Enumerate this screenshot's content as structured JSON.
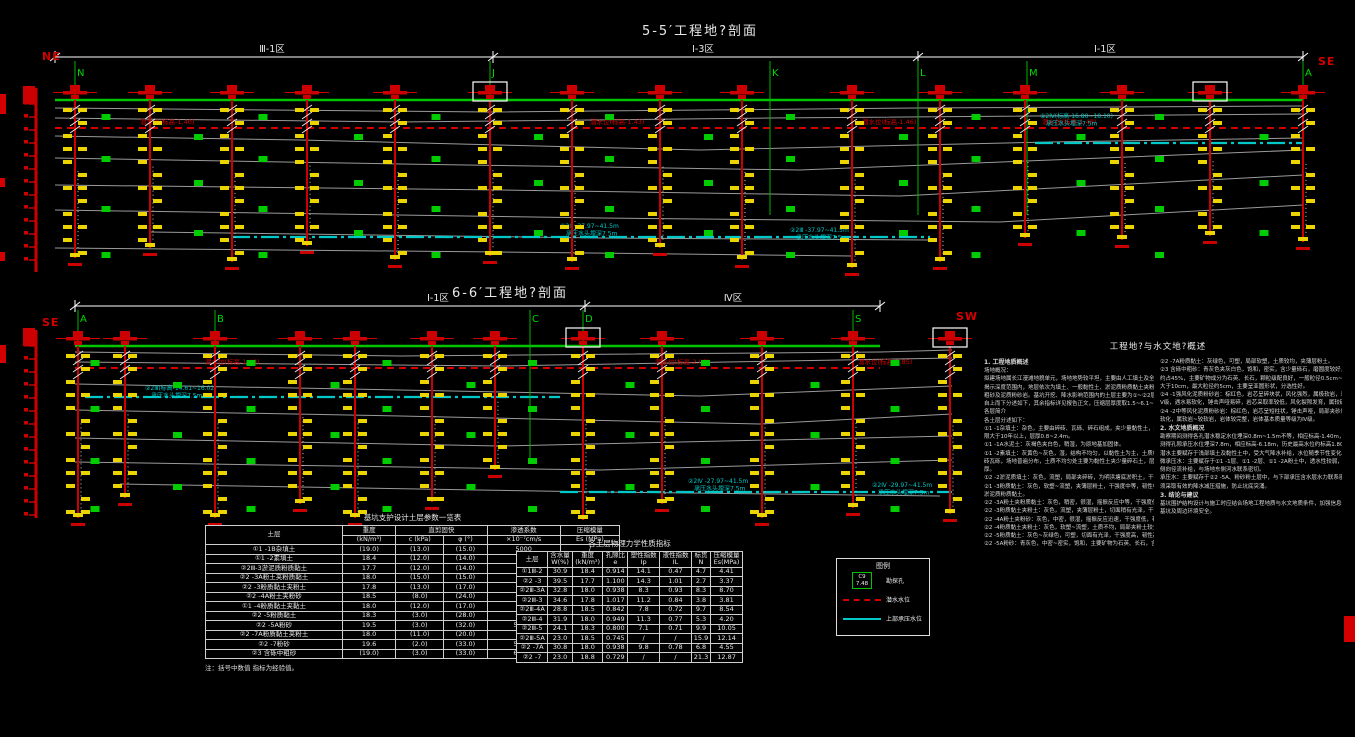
{
  "notes_title": "工程地?与水文地?概述",
  "sections": [
    {
      "id": "5-5",
      "title": "5-5′工程地?剖面",
      "compass_left": "NE",
      "compass_right": "SE",
      "dim_y": 57,
      "x0": 55,
      "x1": 1303,
      "ground_y": 100,
      "letter_y": 76,
      "zones": [
        {
          "from": 55,
          "to": 493,
          "label": "Ⅲ-1区",
          "label_x": 272
        },
        {
          "from": 493,
          "to": 918,
          "label": "Ⅰ-3区",
          "label_x": 703
        },
        {
          "from": 918,
          "to": 1303,
          "label": "Ⅰ-1区",
          "label_x": 1105
        }
      ],
      "markers": [
        {
          "letter": "N",
          "x": 75
        },
        {
          "letter": "J",
          "x": 490
        },
        {
          "letter": "K",
          "x": 770
        },
        {
          "letter": "L",
          "x": 918
        },
        {
          "letter": "M",
          "x": 1027
        },
        {
          "letter": "A",
          "x": 1303
        }
      ],
      "boreholes": [
        {
          "x": 75,
          "b": 258
        },
        {
          "x": 150,
          "b": 248
        },
        {
          "x": 232,
          "b": 262
        },
        {
          "x": 307,
          "b": 246
        },
        {
          "x": 395,
          "b": 260
        },
        {
          "x": 490,
          "b": 256,
          "boxed": true
        },
        {
          "x": 572,
          "b": 262
        },
        {
          "x": 660,
          "b": 248
        },
        {
          "x": 742,
          "b": 260
        },
        {
          "x": 852,
          "b": 268
        },
        {
          "x": 940,
          "b": 262
        },
        {
          "x": 1025,
          "b": 238
        },
        {
          "x": 1122,
          "b": 240
        },
        {
          "x": 1210,
          "b": 236,
          "boxed": true
        },
        {
          "x": 1303,
          "b": 242
        }
      ],
      "waterline": {
        "y": 128,
        "labels": [
          {
            "x": 140,
            "t": "潜水位(标高-1.40)"
          },
          {
            "x": 590,
            "t": "潜水位(标高-1.43)"
          },
          {
            "x": 862,
            "t": "潜水位(标高-1.46)"
          },
          {
            "x": 1042,
            "t": "潜水位(标高-1.48)"
          }
        ]
      },
      "cyan_segments": [
        {
          "x0": 232,
          "x1": 930,
          "y": 237,
          "labels": [
            {
              "x": 560,
              "y": 228,
              "lines": [
                "②2Ⅲ -37.97~41.5m",
                "承压水头埋深7.5m"
              ]
            },
            {
              "x": 790,
              "y": 232,
              "lines": [
                "②2Ⅲ -37.97~41.5m",
                "承压水头埋深7.5m"
              ]
            }
          ]
        },
        {
          "x0": 1035,
          "x1": 1303,
          "y": 143,
          "labels": [
            {
              "x": 1040,
              "y": 118,
              "lines": [
                "②2Ⅳ(标高-16.80~18.10)",
                "承压水头埋深7.5m"
              ]
            }
          ]
        }
      ],
      "gray_lines": [
        [
          [
            55,
            108
          ],
          [
            490,
            112
          ],
          [
            918,
            108
          ],
          [
            1303,
            106
          ]
        ],
        [
          [
            55,
            118
          ],
          [
            400,
            122
          ],
          [
            770,
            118
          ],
          [
            1303,
            114
          ]
        ],
        [
          [
            55,
            136
          ],
          [
            300,
            140
          ],
          [
            700,
            150
          ],
          [
            1050,
            142
          ],
          [
            1303,
            138
          ]
        ],
        [
          [
            55,
            158
          ],
          [
            400,
            164
          ],
          [
            800,
            170
          ],
          [
            1303,
            150
          ]
        ],
        [
          [
            55,
            185
          ],
          [
            500,
            190
          ],
          [
            900,
            196
          ],
          [
            1303,
            175
          ]
        ],
        [
          [
            55,
            210
          ],
          [
            600,
            218
          ],
          [
            1000,
            222
          ],
          [
            1303,
            205
          ]
        ],
        [
          [
            150,
            232
          ],
          [
            600,
            238
          ],
          [
            930,
            240
          ]
        ],
        [
          [
            55,
            248
          ],
          [
            500,
            252
          ],
          [
            852,
            256
          ]
        ]
      ],
      "scatter_offsets": [
        14,
        34,
        56,
        80,
        106,
        130,
        152
      ],
      "scale": {
        "x": 36,
        "y0": 88,
        "y1": 272
      }
    },
    {
      "id": "6-6",
      "title": "6-6′工程地?剖面",
      "compass_left": "SE",
      "compass_right": "SW",
      "dim_y": 306,
      "x0": 75,
      "x1": 880,
      "ground_y": 346,
      "letter_y": 322,
      "zones": [
        {
          "from": 75,
          "to": 585,
          "label": "Ⅰ-1区",
          "label_x": 438
        },
        {
          "from": 585,
          "to": 880,
          "label": "Ⅳ区",
          "label_x": 733
        }
      ],
      "markers": [
        {
          "letter": "A",
          "x": 78
        },
        {
          "letter": "B",
          "x": 215
        },
        {
          "letter": "C",
          "x": 530
        },
        {
          "letter": "D",
          "x": 583
        },
        {
          "letter": "S",
          "x": 853
        }
      ],
      "boreholes": [
        {
          "x": 78,
          "b": 518
        },
        {
          "x": 125,
          "b": 498
        },
        {
          "x": 215,
          "b": 518
        },
        {
          "x": 300,
          "b": 504
        },
        {
          "x": 355,
          "b": 518
        },
        {
          "x": 432,
          "b": 502
        },
        {
          "x": 495,
          "b": 470
        },
        {
          "x": 583,
          "b": 520,
          "boxed": true
        },
        {
          "x": 662,
          "b": 504
        },
        {
          "x": 762,
          "b": 518
        },
        {
          "x": 853,
          "b": 508
        },
        {
          "x": 950,
          "b": 514,
          "boxed": true
        }
      ],
      "waterline": {
        "y": 368,
        "labels": [
          {
            "x": 205,
            "t": "潜水位(标高-1.40)"
          },
          {
            "x": 655,
            "t": "潜水位(标高-2.05)"
          },
          {
            "x": 858,
            "t": "潜水位(标高-2.85)"
          }
        ]
      },
      "cyan_segments": [
        {
          "x0": 85,
          "x1": 560,
          "y": 397,
          "labels": [
            {
              "x": 145,
              "y": 390,
              "lines": [
                "②2Ⅲ(标高-14.61~16.02)",
                "承压水头埋深7.5m"
              ]
            }
          ]
        },
        {
          "x0": 560,
          "x1": 952,
          "y": 492,
          "labels": [
            {
              "x": 688,
              "y": 483,
              "lines": [
                "②2Ⅳ -27.97~41.5m",
                "承压水头埋深7.5m"
              ]
            },
            {
              "x": 872,
              "y": 487,
              "lines": [
                "②2Ⅳ -29.97~41.5m",
                "承压水头埋深7.5m"
              ]
            }
          ]
        }
      ],
      "gray_lines": [
        [
          [
            75,
            352
          ],
          [
            400,
            356
          ],
          [
            880,
            352
          ],
          [
            952,
            350
          ]
        ],
        [
          [
            75,
            362
          ],
          [
            500,
            366
          ],
          [
            952,
            358
          ]
        ],
        [
          [
            75,
            384
          ],
          [
            400,
            390
          ],
          [
            700,
            396
          ],
          [
            952,
            386
          ]
        ],
        [
          [
            75,
            410
          ],
          [
            400,
            416
          ],
          [
            760,
            424
          ],
          [
            952,
            414
          ]
        ],
        [
          [
            75,
            438
          ],
          [
            500,
            446
          ],
          [
            952,
            436
          ]
        ],
        [
          [
            75,
            462
          ],
          [
            600,
            470
          ],
          [
            952,
            460
          ]
        ],
        [
          [
            120,
            484
          ],
          [
            600,
            492
          ],
          [
            940,
            496
          ]
        ]
      ],
      "scatter_offsets": [
        14,
        36,
        60,
        86,
        112,
        138,
        160
      ],
      "scale": {
        "x": 36,
        "y0": 330,
        "y1": 518
      }
    }
  ],
  "tables": [
    {
      "title": "基坑支护设计土层参数一览表",
      "note": "注：括号中数值 指标为经验值。",
      "header_rows": [
        [
          {
            "t": "土层",
            "rs": 2
          },
          {
            "t": "重度"
          },
          {
            "t": "直剪固快",
            "cs": 2
          },
          {
            "t": "渗透系数"
          },
          {
            "t": "压缩模量"
          }
        ],
        [
          {
            "t": "(kN/m³)"
          },
          {
            "t": "c (kPa)"
          },
          {
            "t": "φ (°)"
          },
          {
            "t": "×10⁻⁷cm/s"
          },
          {
            "t": "Es (MPa)"
          }
        ]
      ],
      "rows": [
        [
          "①1 -1B杂填土",
          "(19.0)",
          "(13.0)",
          "(15.0)",
          "5000",
          "/"
        ],
        [
          "①1 -2素填土",
          "18.4",
          "(12.0)",
          "(14.0)",
          "500",
          "/"
        ],
        [
          "②2Ⅲ-3淤泥质粉质黏土",
          "17.7",
          "(12.0)",
          "(14.0)",
          "8",
          "20"
        ],
        [
          "②2 -3A粉土夹粉质黏土",
          "18.0",
          "(15.0)",
          "(15.0)",
          "300",
          "28"
        ],
        [
          "②2 -3粉质黏土夹粉土",
          "17.8",
          "(13.0)",
          "(17.0)",
          "60",
          "30"
        ],
        [
          "②2 -4A粉土夹粉砂",
          "18.5",
          "(8.0)",
          "(24.0)",
          "8000",
          "35"
        ],
        [
          "①1 -4粉质黏土夹黏土",
          "18.0",
          "(12.0)",
          "(17.0)",
          "60",
          "30"
        ],
        [
          "②2 -5粉质黏土",
          "18.3",
          "(3.0)",
          "(28.0)",
          "3000",
          "46"
        ],
        [
          "②2 -5A粉砂",
          "19.5",
          "(3.0)",
          "(32.0)",
          "50000",
          "52"
        ],
        [
          "②2 -7A粉质黏土夹粉土",
          "18.0",
          "(11.0)",
          "(20.0)",
          "80",
          "35"
        ],
        [
          "②2 -7粉砂",
          "19.6",
          "(2.0)",
          "(33.0)",
          "50000",
          "64"
        ],
        [
          "②3 含砾中粗砂",
          "(19.0)",
          "(3.0)",
          "(33.0)",
          "60000",
          "80"
        ]
      ]
    },
    {
      "title": "各土层物理力学性质指标",
      "note": "",
      "header_rows": [
        [
          {
            "t": "土层"
          },
          {
            "t": "含水量\nW(%)"
          },
          {
            "t": "重度\n(kN/m³)"
          },
          {
            "t": "孔隙比\ne"
          },
          {
            "t": "塑性指数\nIp"
          },
          {
            "t": "液性指数\nIL"
          },
          {
            "t": "标贯\nN"
          },
          {
            "t": "压缩模量\nEs(MPa)"
          }
        ]
      ],
      "rows": [
        [
          "①1Ⅲ-2",
          "30.9",
          "18.4",
          "0.914",
          "14.1",
          "0.47",
          "4.7",
          "4.41"
        ],
        [
          "②2 -3",
          "39.5",
          "17.7",
          "1.100",
          "14.3",
          "1.01",
          "2.7",
          "3.37"
        ],
        [
          "②2Ⅲ-3A",
          "32.8",
          "18.0",
          "0.938",
          "8.3",
          "0.93",
          "8.3",
          "8.70"
        ],
        [
          "②2Ⅲ-3",
          "34.6",
          "17.8",
          "1.017",
          "11.2",
          "0.84",
          "3.8",
          "3.81"
        ],
        [
          "②2Ⅲ-4A",
          "28.8",
          "18.5",
          "0.842",
          "7.8",
          "0.72",
          "9.7",
          "8.54"
        ],
        [
          "②2Ⅲ-4",
          "31.9",
          "18.0",
          "0.949",
          "11.3",
          "0.77",
          "5.3",
          "4.20"
        ],
        [
          "②2Ⅲ-5",
          "24.1",
          "18.3",
          "0.800",
          "7.1",
          "0.71",
          "9.9",
          "10.05"
        ],
        [
          "②2Ⅲ-5A",
          "23.0",
          "18.5",
          "0.745",
          "/",
          "/",
          "15.9",
          "12.14"
        ],
        [
          "②2 -7A",
          "30.8",
          "18.0",
          "0.938",
          "9.8",
          "0.78",
          "6.8",
          "4.55"
        ],
        [
          "②2 -7",
          "23.0",
          "18.8",
          "0.729",
          "/",
          "/",
          "21.3",
          "12.87"
        ]
      ]
    }
  ],
  "legend": {
    "title": "图例",
    "items": [
      {
        "label": "勘探孔",
        "symbol_text": "C9\n7.48",
        "kind": "borehole"
      },
      {
        "label": "潜水水位",
        "kind": "red-dash"
      },
      {
        "label": "上部承压水位",
        "kind": "cyan-line"
      }
    ]
  },
  "notes": {
    "col1": [
      "1. 工程地质概述",
      "场地概况：",
      "拟建场地属长江漫滩地貌单元，场地地势较平坦，主要由人工填土及全新统冲积层组成。钻探",
      "揭示深度范围内，地层依次为填土、一般黏性土、淤泥质粉质黏土夹粉土、粉砂夹粉土、含砾中",
      "粗砂及泥质粉砂岩。基坑开挖、降水影响范围内的土层主要为①~②2层土，各土层的工程特性",
      "自上而下分述如下，其余指标详见报告正文，压缩层厚度取1.5~6.1~2.0m。",
      "各层简介",
      "各土层分述如下：",
      "①1 -1杂填土：杂色，主要由碎砖、瓦砾、碎石组成，夹少量黏性土，结构松散~稍密，堆填年",
      "限大于10年以上，层厚0.8~2.4m。",
      "①1 -1A水泥土：灰褐色夹白色，稍湿，为原地基加固体。",
      "①1 -2素填土：灰黄色~灰色，湿，结构不均匀，以黏性土为主，土质松软且欠固结，局部夹碎",
      "砖瓦砾，场地普遍分布，土质不均匀处主要为黏性土夹少量碎石土，层厚不均匀局部大于2m",
      "厚。",
      "①2 -2淤泥质填土：灰色，流塑，局部夹碎砖，为明浜塘底淤积土，干强度中等韧性中等。",
      "②1 -3粉质黏土：灰色，软塑~流塑，夹薄层粉土，干强度中等，韧性中等，土质不均，局部为",
      "淤泥质粉质黏土。",
      "②2 -3A粉土夹粉质黏土：灰色，稍密，很湿，摇振反应中等，干强度低，韧性低，夹粉砂薄层。",
      "②2 -3粉质黏土夹粉土：灰色，流塑，夹薄层粉土，切面稍有光泽，干强度中等，韧性中等。",
      "②2 -4A粉土夹粉砂：灰色，中密，很湿，摇振反应迅速，干强度低，韧性低，夹粉质黏土薄层。",
      "②2 -4粉质黏土夹粉土：灰色，软塑~流塑，土质不均，局部夹粉土较多。",
      "②2 -5粉质黏土：灰色~灰绿色，可塑，切面有光泽，干强度高，韧性高，土质较均。",
      "②2 -5A粉砂：青灰色，中密~密实，饱和，主要矿物为石英、长石，含云母碎屑，土质较好。"
    ],
    "col2": [
      "②2 -7A粉质黏土：灰绿色，可塑，局部软塑，土质较均，夹薄层粉土。",
      "②3 含砾中粗砂：青灰色夹灰白色，饱和，密实，含少量砾石，磨圆度较好，不均匀系数大，一般粒径",
      "约占45%，主要矿物成分为石英、长石，颗粒级配良好，一般粒径0.5cm~8cm不等，个别粒径",
      "大于10cm，最大粒径约5cm，主要呈亚圆形状，分选性好。",
      "②4 -1强风化泥质粉砂岩：棕红色，岩芯呈碎块状，风化强烈，属极软岩，岩体基本质量等级为",
      "Ⅴ级，遇水易软化，锤击声哑易碎，岩芯采取率较低，风化裂隙发育，属较破碎岩体。",
      "②4 -2中等风化泥质粉砂岩：棕红色，岩芯呈短柱状，锤击声哑，局部夹砂质泥岩，遇水一般不",
      "软化，属软岩~较软岩，岩体较完整，岩体基本质量等级为Ⅳ级。",
      "2. 水文地质概况",
      "勘察期间测得各孔潜水稳定水位埋深0.8m~1.5m不等，相应标高-1.40m，2018年6月21日，",
      "测得孔隙承压水位埋深7.8m，相应标高-6.18m，历史最高水位约标高1.80m~2.10m。",
      "潜水主要赋存于浅部填土及黏性土中，受大气降水补给，水位随季节性变化。",
      "微承压水：主要赋存于①1 -1层、①1 -2层、①1 -2A粉土中，透水性较弱，主要接受大气降水及",
      "侧向径流补给，与场地东侧河水联系密切。",
      "承压水：主要赋存于②2 -5A、粉砂粉土层中，与下部承压含水层水力联系密切，基坑开挖时，",
      "须采取有效的降水减压措施，防止坑底突涌。",
      "3. 结论与建议",
      "基坑围护结构设计与施工时应结合场地工程地质与水文地质条件，加强信息化施工监测，确保",
      "基坑及周边环境安全。"
    ]
  },
  "edge_marks": [
    {
      "x": 0,
      "y": 94,
      "w": 6,
      "h": 20
    },
    {
      "x": 0,
      "y": 178,
      "w": 5,
      "h": 9
    },
    {
      "x": 0,
      "y": 252,
      "w": 5,
      "h": 9
    },
    {
      "x": 0,
      "y": 345,
      "w": 6,
      "h": 18
    },
    {
      "x": 1344,
      "y": 616,
      "w": 11,
      "h": 26
    }
  ],
  "colors": {
    "ground": "#00c400",
    "borehole": "#cc0000",
    "tick": "#ecd400",
    "water": "#d40000",
    "confined": "#00c8c8",
    "layer_line": "#9a9a9a",
    "marker": "#00d800",
    "dim": "#ffffff"
  }
}
